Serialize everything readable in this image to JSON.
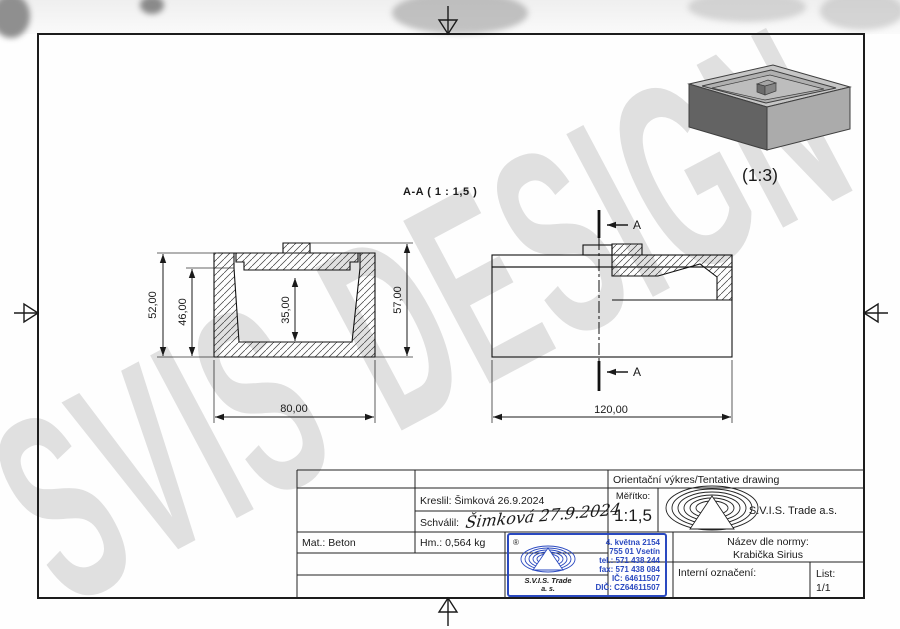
{
  "sheet": {
    "watermark": "SVIS DESIGN",
    "section_view": {
      "label": "A-A ( 1 : 1,5 )",
      "dim_total_height": "57,00",
      "dim_outer_height": "52,00",
      "dim_inner_height": "46,00",
      "dim_cavity_depth": "35,00",
      "dim_width": "80,00"
    },
    "side_view": {
      "dim_width": "120,00",
      "cut_label_top": "A",
      "cut_label_bottom": "A"
    },
    "iso_view": {
      "scale_label": "(1:3)"
    }
  },
  "title_block": {
    "tentative_label": "Orientační výkres/Tentative drawing",
    "scale_label": "Měřítko:",
    "scale_value": "1:1,5",
    "company_name": "S.V.I.S. Trade a.s.",
    "drawn_by": "Kreslil: Šimková 26.9.2024",
    "approved_label": "Schválil:",
    "approved_signature": "Šimková 27.9.2024",
    "material": "Mat.: Beton",
    "weight": "Hm.: 0,564 kg",
    "norm_name_label": "Název dle normy:",
    "norm_name_value": "Krabička Sirius",
    "internal_id_label": "Interní označení:",
    "sheet_label": "List:",
    "sheet_number": "1/1"
  },
  "stamp": {
    "registered_mark": "®",
    "company_line1": "S.V.I.S. Trade",
    "company_line2": "a. s.",
    "address_line1": "4. května 2154",
    "address_line2": "755 01 Vsetín",
    "phone": "tel.: 571 438 244",
    "fax": "fax: 571 438 084",
    "company_id": "IČ: 64611507",
    "vat_id": "DIČ: CZ64611507"
  },
  "colors": {
    "ink": "#1a1a1a",
    "stamp_blue": "#2a49c0",
    "signature_blue": "#2c52c8",
    "watermark_gray": "#cdcdcd"
  }
}
